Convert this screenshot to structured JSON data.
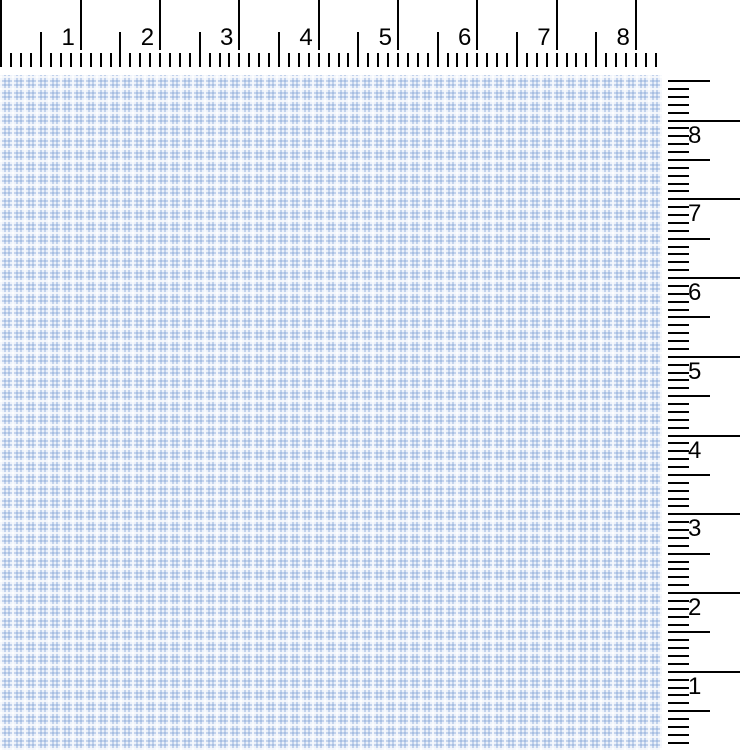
{
  "window": {
    "width_px": 740,
    "height_px": 750,
    "background": "#ffffff"
  },
  "rulers": {
    "unit": "inches",
    "tick_color": "#000000",
    "label_color": "#000000",
    "label_font_px": 24,
    "top": {
      "orientation": "horizontal",
      "labels": [
        "1",
        "2",
        "3",
        "4",
        "5",
        "6",
        "7",
        "8"
      ],
      "position": {
        "left": 0,
        "top": 0,
        "width": 662,
        "height": 68
      },
      "origin_offset_px": 1.5,
      "pixels_per_inch": 79.3,
      "minor_per_inch": 8,
      "max_value": 8.3,
      "inch_tick": {
        "top": 0,
        "height": 50,
        "width": 2
      },
      "half_tick": {
        "top": 32,
        "height": 21,
        "width": 2
      },
      "minor_tick": {
        "top": 53,
        "height": 14,
        "width": 2
      },
      "origin_line": {
        "left": 0,
        "top": 0,
        "width": 2,
        "height": 67
      },
      "label_top": 26,
      "label_gap": 6
    },
    "right": {
      "orientation": "vertical",
      "labels": [
        "8",
        "7",
        "6",
        "5",
        "4",
        "3",
        "2",
        "1"
      ],
      "position": {
        "left": 666,
        "top": 72,
        "width": 74,
        "height": 678
      },
      "zero_at_page_y_px": 750.5,
      "pixels_per_inch": 78.75,
      "minor_per_inch": 10,
      "max_value": 8.5,
      "tick_left": 2,
      "inch_tick": {
        "length": 72,
        "thickness": 2
      },
      "half_tick": {
        "length": 42,
        "thickness": 2
      },
      "minor_tick": {
        "length": 21,
        "thickness": 2
      },
      "label_left": 22,
      "label_offset_below_line": 3
    }
  },
  "canvas": {
    "description": "blue gingham plaid pattern area",
    "position": {
      "left": 0,
      "top": 75,
      "width": 662,
      "height": 675
    },
    "base_color": "#edf2fa",
    "stripe_color": "rgba(124,159,212,0.38)",
    "highlight_color": "rgba(255,255,255,0.85)",
    "stripe_period_px": 4,
    "stripe_width_px": 2,
    "highlight_period_px": 12,
    "highlight_width_px": 2
  }
}
